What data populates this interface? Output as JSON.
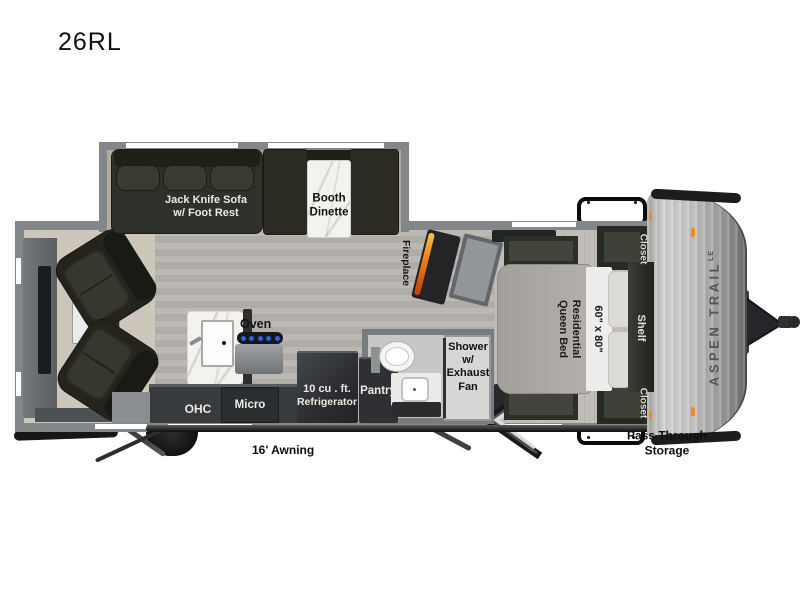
{
  "title": "26RL",
  "brand": {
    "name_vertical": "ASPEN TRAIL",
    "badge": "LE"
  },
  "living": {
    "sofa_line1": "Jack Knife Sofa",
    "sofa_line2": "w/ Foot Rest",
    "dinette_line1": "Booth",
    "dinette_line2": "Dinette",
    "fireplace": "Fireplace"
  },
  "kitchen": {
    "oven": "Oven",
    "ohc": "OHC",
    "micro": "Micro",
    "fridge_line1": "10 cu . ft.",
    "fridge_line2": "Refrigerator",
    "pantry": "Pantry"
  },
  "bath": {
    "shower_line1": "Shower",
    "shower_line2": "w/",
    "shower_line3": "Exhaust",
    "shower_line4": "Fan"
  },
  "bedroom": {
    "bed_line1": "Residential",
    "bed_line2": "Queen Bed",
    "bed_size": "60\" x 80\"",
    "closet_top": "Closet",
    "shelf": "Shelf",
    "closet_bottom": "Closet"
  },
  "exterior": {
    "awning": "16' Awning",
    "pass_through_line1": "Pass Through",
    "pass_through_line2": "Storage"
  },
  "colors": {
    "wall": "#84878a",
    "floor": "#b4b1ac",
    "carpet": "#cdc7bb",
    "dark_furniture": "#2b2b24",
    "counter": "#383b3d",
    "marble": "#f3f2ef",
    "flame": "#f0831e",
    "burner_blue": "#2a62e8",
    "cap_silver": "#c2c2c0",
    "marker": "#ef8b1a"
  }
}
